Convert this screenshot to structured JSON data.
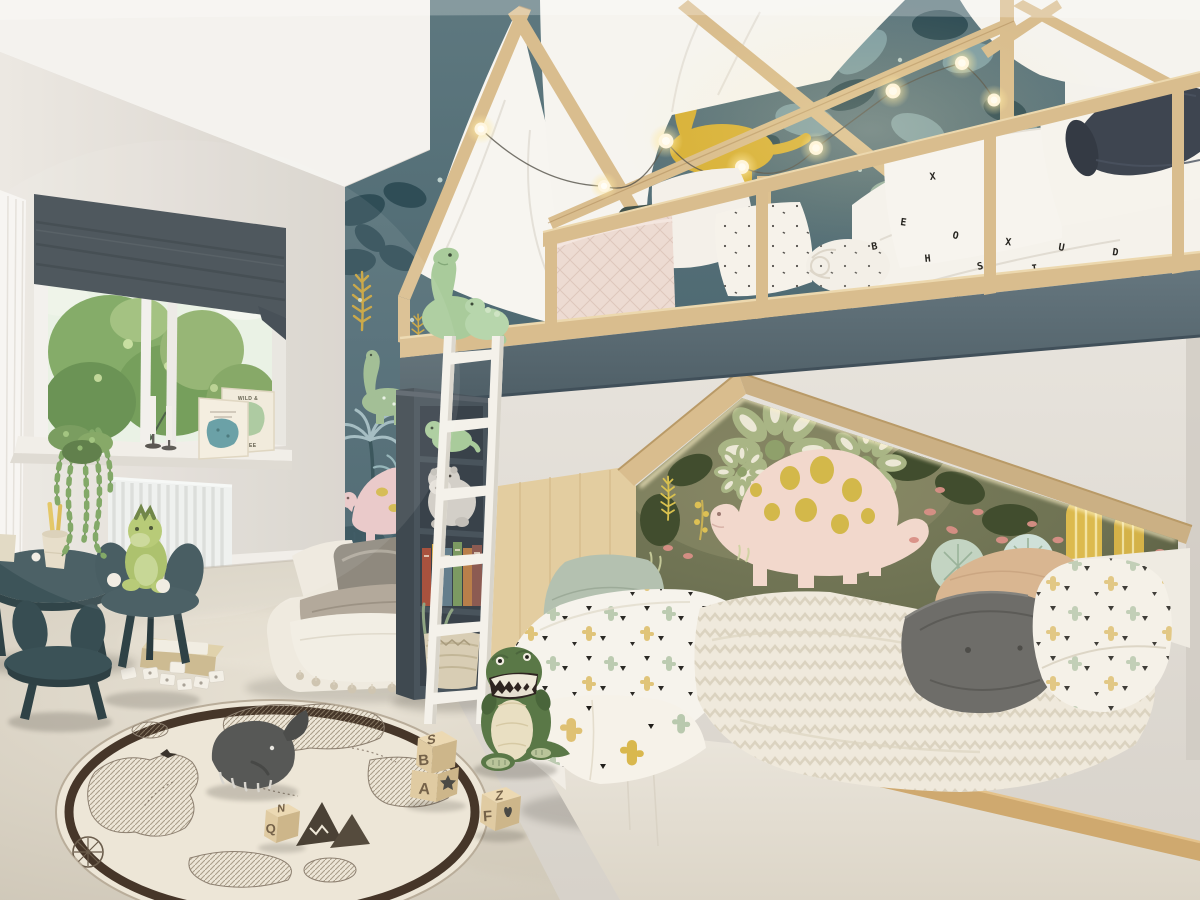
{
  "scene": {
    "title": "Children's bedroom with house-frame bunk bed",
    "style": "photorealistic interior render",
    "room": "kids bedroom with dinosaur theme"
  },
  "palette": {
    "wall": "#e7e3dd",
    "wallShade": "#d6d1ca",
    "ceiling": "#f4f2ee",
    "curtain": "#f7f5f1",
    "blind": "#414a51",
    "windowFrame": "#f0ede8",
    "foliage": "#79a359",
    "foliageDark": "#5a8444",
    "radiator": "#eef0ee",
    "wpTop": "#5e787f",
    "wpBot": "#44606a",
    "leafDark": "#2f4d56",
    "leafBlue": "#7e9ea4",
    "palmBlue": "#9fb9be",
    "fernYellow": "#c7a23b",
    "accentPink": "#d7a3a9",
    "wpDinoGreen": "#9cba8e",
    "wpDinoYellow": "#d8b137",
    "wpStegoPink": "#e9c6c6",
    "wood": "#d9bd8e",
    "woodDark": "#c4a271",
    "woodLight": "#ecd8ae",
    "fascia": "#5c6e76",
    "canopy": "#f7f5f0",
    "sheetWhite": "#f5f2eb",
    "quiltPink": "#eddbd2",
    "bolsterNavy": "#3e4550",
    "cushionTeal": "#42524b",
    "mural": "#6d7152",
    "muralDark": "#4e5338",
    "muralSage": "#a9b585",
    "muralLeafDark": "#414d2e",
    "cactusYellow": "#dcba4e",
    "berryPink": "#d99086",
    "muralPaleLeaf": "#c3d4c2",
    "stegoPink": "#f2d8cc",
    "stegoSpot": "#d3b84a",
    "pillowSage": "#b4c1b0",
    "pillowGrey": "#6e6d69",
    "pillowTan": "#d9b691",
    "duvetWhite": "#f6f3ec",
    "chevron": "#efe9dc",
    "chevronLine": "#d9d0bd",
    "base": "#ece7dd",
    "carpet": "#d9d2c4",
    "carpetDark": "#c3bbaa",
    "rugField": "#ede6d7",
    "rugBorder": "#463629",
    "rugMap": "#8d8071",
    "shelf": "#49545c",
    "ladder": "#f4f1ea",
    "table": "#3d5459",
    "tableDark": "#2f4246",
    "trex": "#5a7847",
    "trexDark": "#49653a",
    "trexBelly": "#e9dfc2",
    "plush": "#a9cb9b",
    "hippo": "#d3cfc8",
    "whale": "#575856",
    "blockTop": "#ecd9b3",
    "blockFront": "#e0cba2",
    "blockSide": "#cdb68a",
    "letterBrown": "#756249",
    "glyphDark": "#4b4a45",
    "basket": "#d8cdb4"
  },
  "poster": {
    "line1": "WILD &",
    "line2": "FREE"
  },
  "blocks": {
    "stack_top": "S",
    "stack_front": "B",
    "stack_lower_front": "A",
    "loose_top": "Z",
    "loose_front": "F",
    "far_top": "N",
    "far_front": "Q"
  },
  "upper_bed": {
    "letters": [
      "B",
      "E",
      "H",
      "O",
      "S",
      "X",
      "I",
      "U",
      "N",
      "D",
      "K",
      "E",
      "B",
      "O",
      "M",
      "I",
      "S",
      "H",
      "X",
      "E"
    ]
  },
  "inventory": [
    "house-frame loft bunk bed",
    "wooden safety railing",
    "string lights",
    "white canopy drape",
    "dinosaur jungle wallpaper",
    "dinosaur mural in bed alcove",
    "lower bed with cactus print bedding",
    "chevron duvet",
    "sage green pillow",
    "grey tufted pillow",
    "tan pillow",
    "white ladder",
    "dark bookshelf with plush toys and books",
    "floor cushion daybed with pom-pom blanket",
    "window with roman blind and garden view",
    "radiator",
    "two art cards on sill",
    "hanging trailing plant",
    "kids round table with paper cups",
    "mouse-ear chairs",
    "green dinosaur plush on chair",
    "T-rex plush",
    "plush brontosaurus pair on ledge",
    "grey hippo plush",
    "world map rug",
    "whale plush",
    "alphabet wooden blocks",
    "memory cards and wooden box",
    "beige carpet"
  ]
}
